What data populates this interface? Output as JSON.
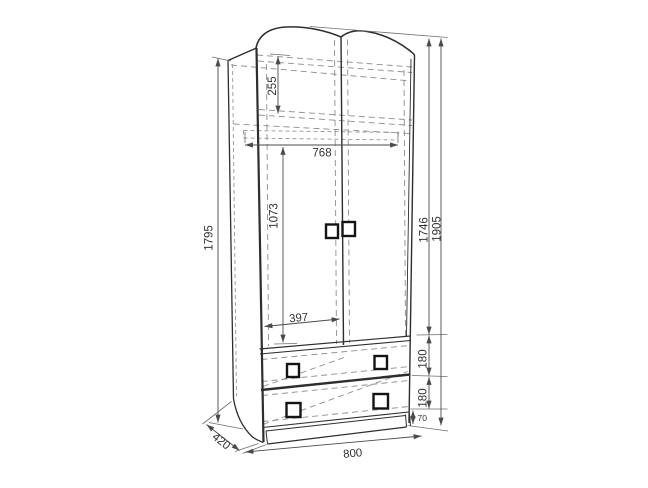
{
  "drawing": {
    "subject": "wardrobe-two-doors-two-drawers",
    "palette": {
      "background": "#ffffff",
      "solid_lines": "#2e2e2e",
      "hidden_lines": "#8d8d8d",
      "dimension_lines": "#4a4a4a",
      "handles": "#141414",
      "text": "#333333"
    }
  },
  "dimensions": {
    "side_panel_height": {
      "value": "1795",
      "orientation": "vertical"
    },
    "top_section_height": {
      "value": "255",
      "orientation": "vertical"
    },
    "interior_width": {
      "value": "768",
      "orientation": "horizontal"
    },
    "hanging_section_height": {
      "value": "1073",
      "orientation": "vertical"
    },
    "door_half_width": {
      "value": "397",
      "orientation": "horizontal"
    },
    "door_height": {
      "value": "1746",
      "orientation": "vertical"
    },
    "overall_height": {
      "value": "1905",
      "orientation": "vertical"
    },
    "upper_drawer_height": {
      "value": "180",
      "orientation": "vertical"
    },
    "lower_drawer_height": {
      "value": "180",
      "orientation": "vertical"
    },
    "plinth_height": {
      "value": "70",
      "orientation": "vertical"
    },
    "depth": {
      "value": "420",
      "orientation": "diagonal"
    },
    "overall_width": {
      "value": "800",
      "orientation": "horizontal"
    }
  }
}
